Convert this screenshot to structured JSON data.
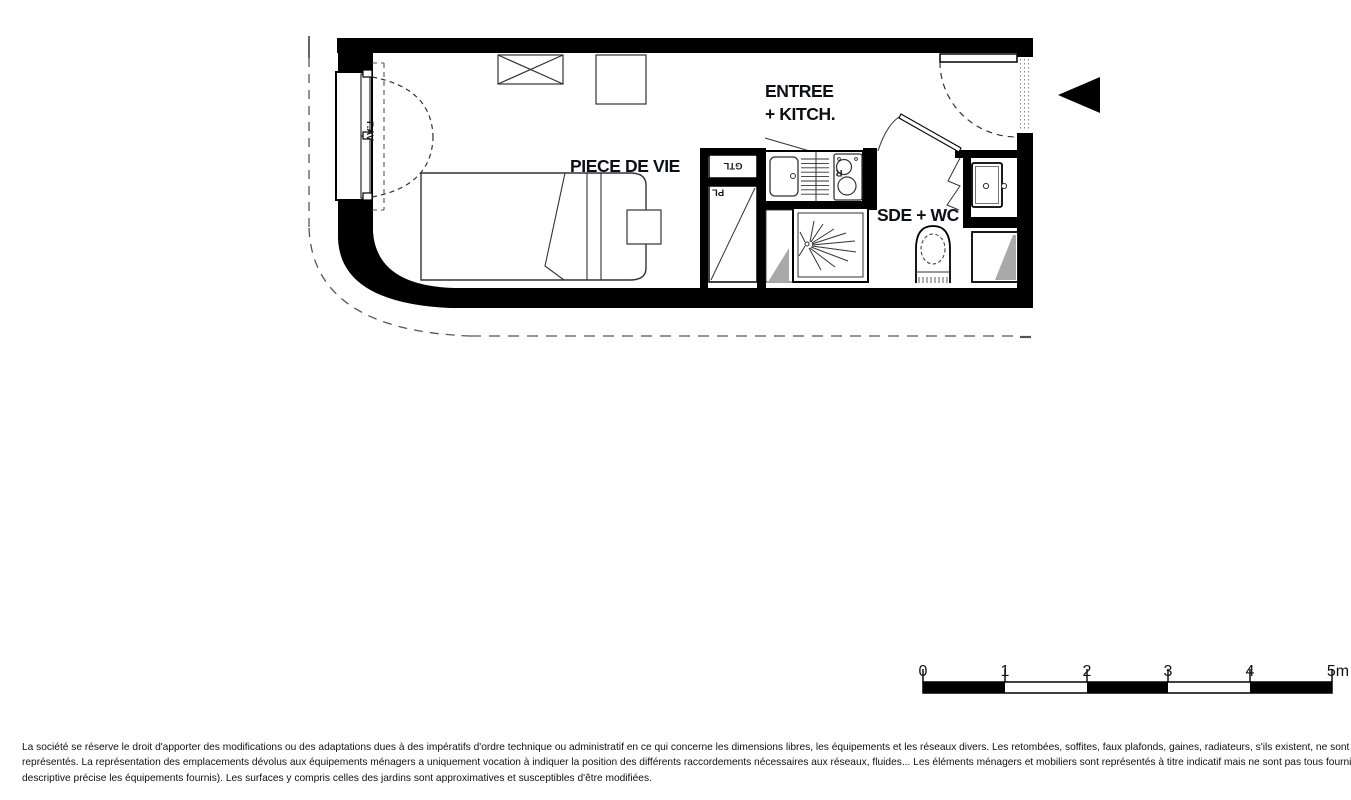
{
  "floor_plan": {
    "rooms": {
      "living_room": "PIECE DE VIE",
      "entry_kitchen_line1": "ENTREE",
      "entry_kitchen_line2": "+ KITCH.",
      "shower_wc": "SDE + WC"
    },
    "annotations": {
      "technical_duct": "GTL",
      "closet": "PL",
      "fridge": "R",
      "front_window": "F.AV"
    }
  },
  "scale_bar": {
    "unit_labels": [
      "0",
      "1",
      "2",
      "3",
      "4",
      "5m"
    ]
  },
  "disclaimer": {
    "line1": "La société se réserve le droit d'apporter des modifications ou des adaptations dues à des impératifs d'ordre technique ou administratif en ce qui concerne les dimensions libres, les équipements et les réseaux divers. Les retombées, soffites, faux plafonds, gaines, radiateurs, s'ils existent, ne sont pas tous",
    "line2": "représentés. La représentation des emplacements dévolus aux équipements ménagers a uniquement vocation à indiquer la position des différents raccordements nécessaires aux réseaux, fluides... Les éléments ménagers et mobiliers sont représentés à titre indicatif mais ne sont pas tous fournis (seule la notice",
    "line3": "descriptive précise les équipements fournis). Les surfaces y compris celles des jardins sont approximatives et susceptibles d'être modifiées."
  },
  "colors": {
    "wall": "#000000",
    "thin_line": "#333333",
    "duct_shading": "#a9a9a9",
    "label_text": "#0e0e16"
  }
}
